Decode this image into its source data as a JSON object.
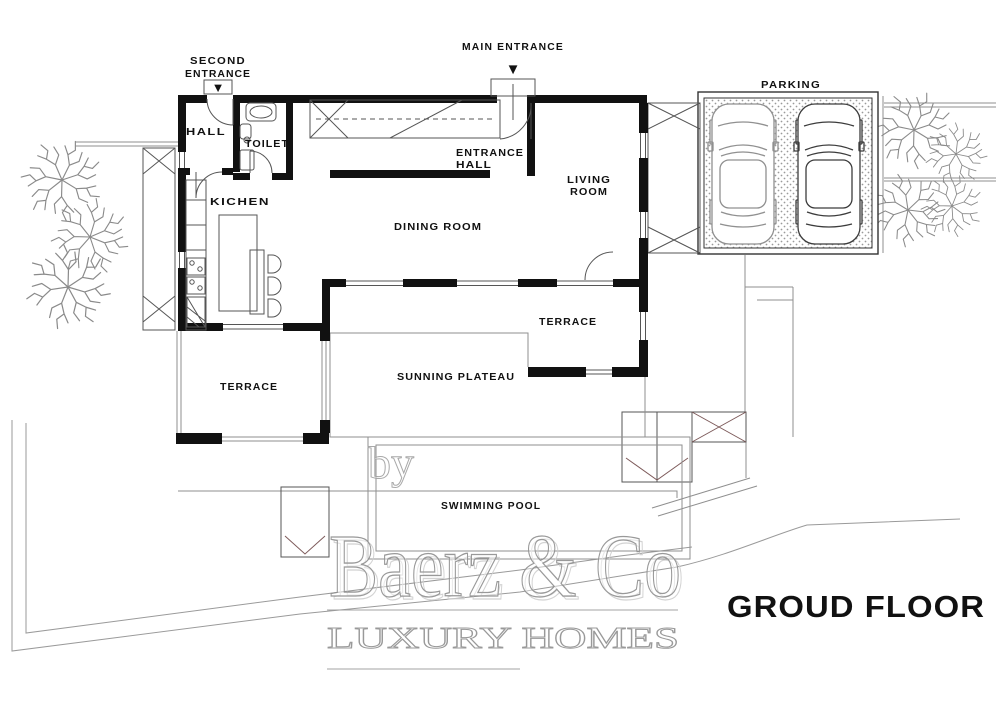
{
  "page": {
    "background": "#ffffff"
  },
  "title": {
    "text": "GROUD FLOOR"
  },
  "watermark": {
    "by": "by",
    "brand": "Baerz & Co",
    "tagline": "LUXURY HOMES"
  },
  "icons": {
    "down_arrow": "▼"
  },
  "annotations": {
    "main_entrance": "MAIN ENTRANCE",
    "second_entrance_line1": "SECOND",
    "second_entrance_line2": "ENTRANCE",
    "parking": "PARKING"
  },
  "rooms": {
    "hall": "HALL",
    "toilet": "TOILET",
    "entrance_hall_line1": "ENTRANCE",
    "entrance_hall_line2": "HALL",
    "living_room_line1": "LIVING",
    "living_room_line2": "ROOM",
    "kitchen": "KICHEN",
    "dining_room": "DINING ROOM",
    "terrace_upper": "TERRACE",
    "sunning_plateau": "SUNNING PLATEAU",
    "terrace_lower": "TERRACE",
    "swimming_pool": "SWIMMING POOL"
  },
  "colors": {
    "wall": "#111111",
    "line": "#555555",
    "light_line": "#8f8f8f",
    "stair_accent": "#7d5a5a",
    "watermark_gray": "#9a9a9a",
    "dots": "#9a9a9a",
    "text": "#111111"
  }
}
